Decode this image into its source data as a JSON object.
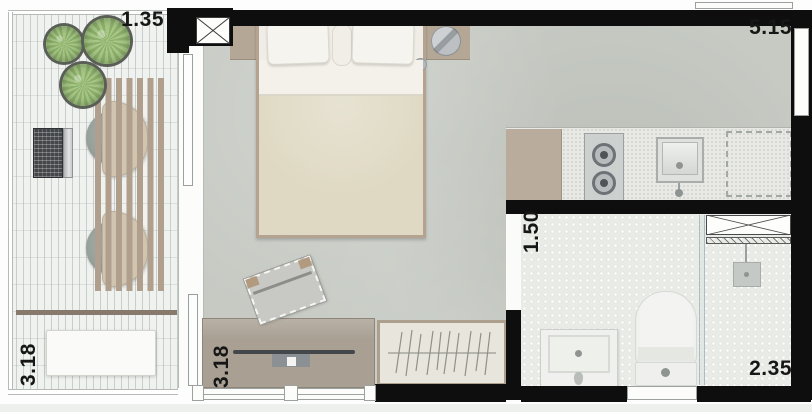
{
  "plan": {
    "title": "Studio apartment floor plan",
    "dimensions": [
      {
        "id": "balcony-width",
        "label": "1.35",
        "orientation": "horizontal"
      },
      {
        "id": "room-width",
        "label": "5.15",
        "orientation": "horizontal"
      },
      {
        "id": "balcony-depth",
        "label": "3.18",
        "orientation": "vertical"
      },
      {
        "id": "room-depth",
        "label": "3.18",
        "orientation": "vertical"
      },
      {
        "id": "bathroom-depth",
        "label": "1.50",
        "orientation": "vertical"
      },
      {
        "id": "bathroom-width",
        "label": "2.35",
        "orientation": "horizontal"
      }
    ],
    "furniture": [
      "potted-plant",
      "potted-plant",
      "potted-plant",
      "slat-desk",
      "laptop",
      "lounge-chair",
      "lounge-chair",
      "planter-bench",
      "double-bed",
      "pillows",
      "bedside-bowl",
      "chaise",
      "tv-sideboard",
      "tv",
      "wardrobe",
      "kitchen-cabinet",
      "cooktop",
      "kitchen-sink",
      "appliance-space",
      "shower-niche",
      "shower-head",
      "glass-partition",
      "toilet",
      "vanity-sink"
    ],
    "colors": {
      "wall": "#0e0e0e",
      "bedroom_floor": "#c6cac3",
      "balcony_floor": "#f0f2f0",
      "bathroom_floor": "#e9ebe7",
      "counter": "#e8e9e5",
      "wood": "#b3a390",
      "wood_dark": "#a9a093",
      "duvet": "#dfd9c3",
      "linen": "#f6f4ee",
      "plant_green": "#a8c887",
      "chair_back": "#d1c5b0",
      "cushion_gray": "#929c97",
      "glass": "#aebcbf"
    }
  }
}
